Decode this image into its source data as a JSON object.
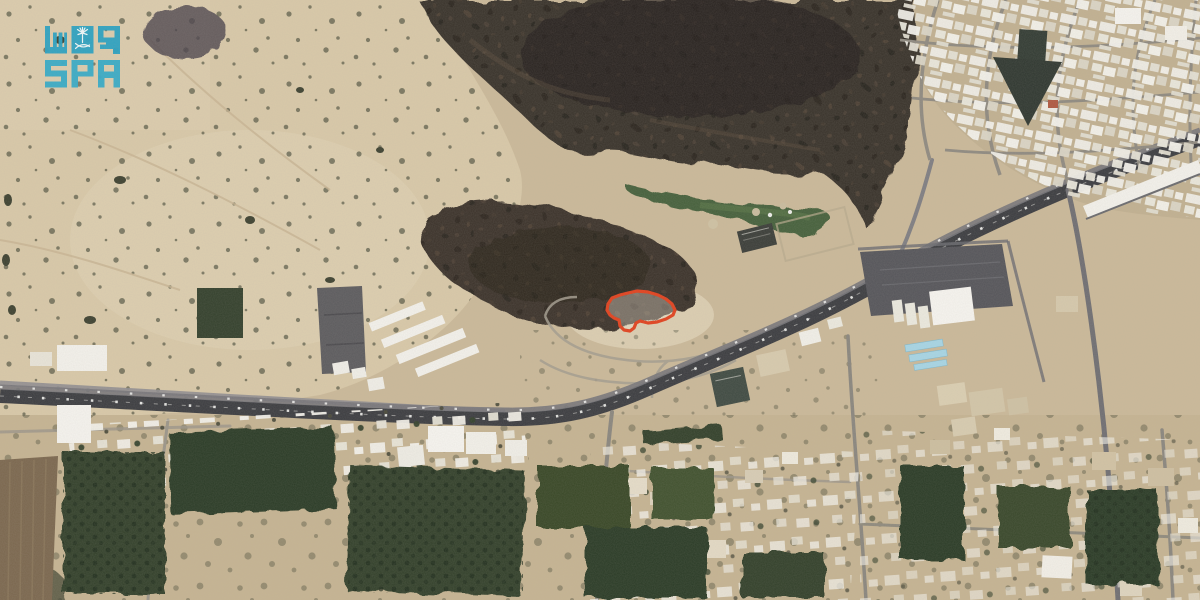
{
  "watermark": {
    "agency_name_arabic": "واس",
    "agency_name_latin": "SPA",
    "logo_color": "#2fa8c6",
    "emblem": "palm-tree-and-crossed-swords"
  },
  "annotation": {
    "label": "highlighted land plot boundary",
    "color": "#e2411d",
    "points": "608,304 612,298 620,295 628,293 637,291 648,292 658,295 666,299 672,304 675,310 673,315 666,319 657,322 648,323 640,321 636,323 634,328 630,331 624,330 620,326 619,320 614,318 610,315 607,310"
  },
  "scene": {
    "type": "satellite aerial photograph of a desert town",
    "features": {
      "desert_sand": "#d9c9a8",
      "rocky_hills": "#37302a",
      "highway_asphalt": "#3b3c40",
      "minor_roads": "#9b958a",
      "buildings": "#f5f3ee",
      "park_green": "#45603a",
      "farm_plots": "#2f3f29",
      "blue_roofs": "#a7d6e6"
    }
  }
}
